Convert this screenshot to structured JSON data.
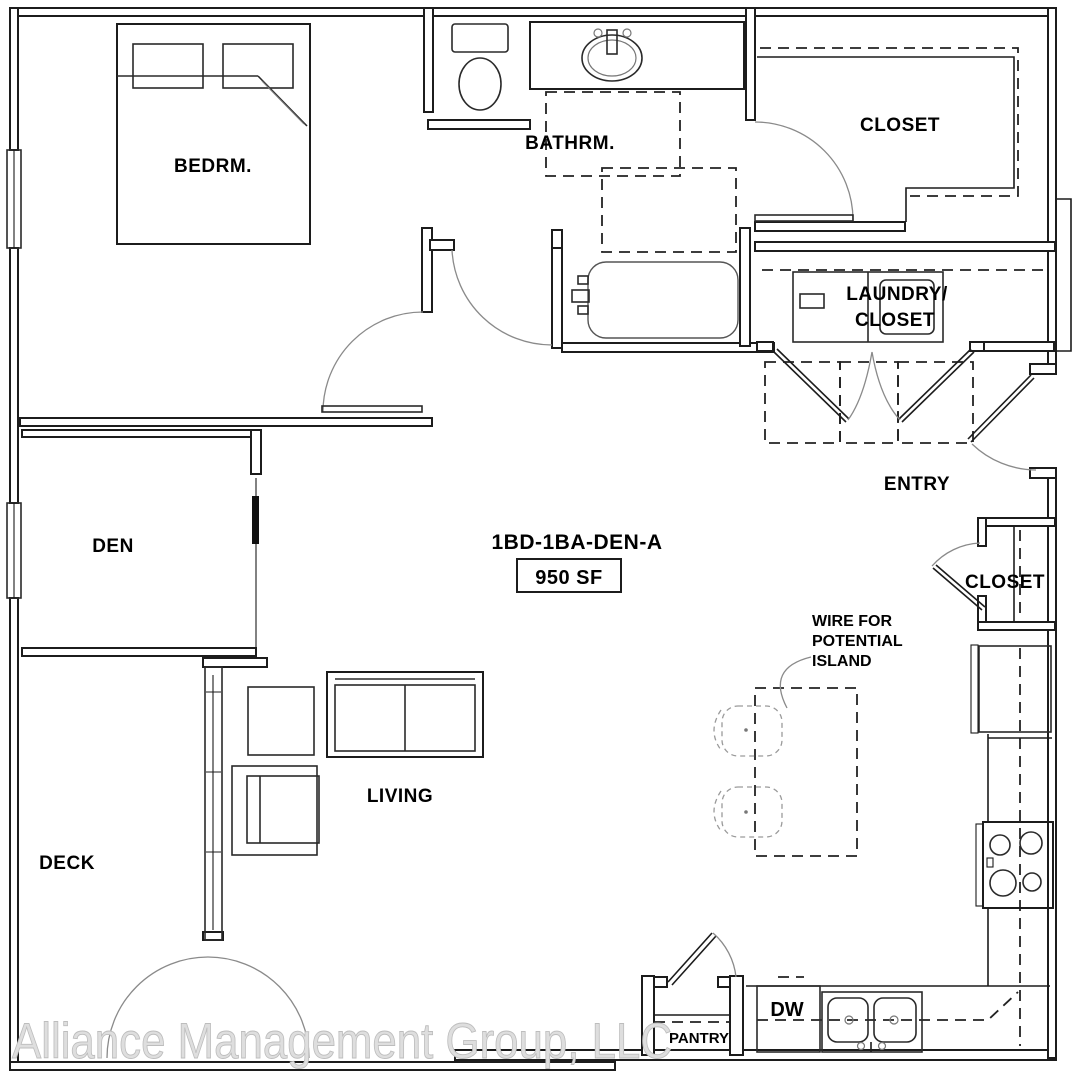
{
  "floor_plan": {
    "title": "1BD-1BA-DEN-A",
    "area_label": "950 SF",
    "watermark": "Alliance Management Group, LLC",
    "rooms": {
      "bedroom": "BEDRM.",
      "bathroom": "BATHRM.",
      "closet_main": "CLOSET",
      "laundry_closet_line1": "LAUNDRY/",
      "laundry_closet_line2": "CLOSET",
      "entry": "ENTRY",
      "den": "DEN",
      "closet_entry": "CLOSET",
      "living": "LIVING",
      "deck": "DECK",
      "pantry": "PANTRY"
    },
    "appliances": {
      "dishwasher": "DW"
    },
    "notes": {
      "island_line1": "WIRE FOR",
      "island_line2": "POTENTIAL",
      "island_line3": "ISLAND"
    },
    "colors": {
      "wall_line": "#1c1c1c",
      "door_arc": "#8a8a8a",
      "label_text": "#000000",
      "watermark_fill": "#dedede"
    }
  }
}
